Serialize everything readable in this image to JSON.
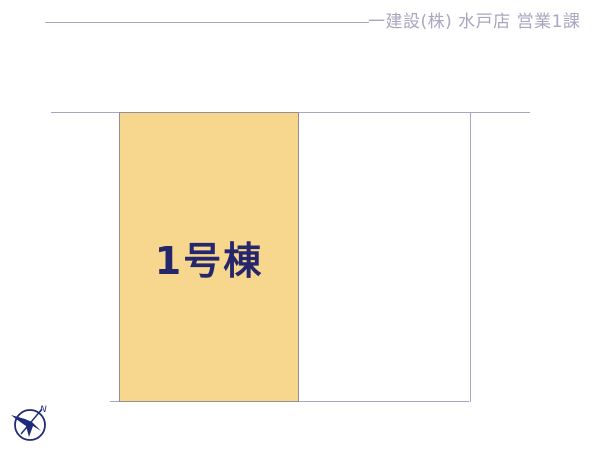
{
  "header": {
    "company": "一建設(株) 水戸店 営業1課"
  },
  "diagram": {
    "lot1_label": "1号棟",
    "lot2_label": "",
    "compass_north_label": "N"
  },
  "colors": {
    "lot1_fill": "#F7D78E",
    "lot_border": "#948F92",
    "boundary_line": "#A6A6C9",
    "building_label": "#26266D",
    "header_text": "#ABA5C0",
    "compass": "#1F2A78"
  }
}
